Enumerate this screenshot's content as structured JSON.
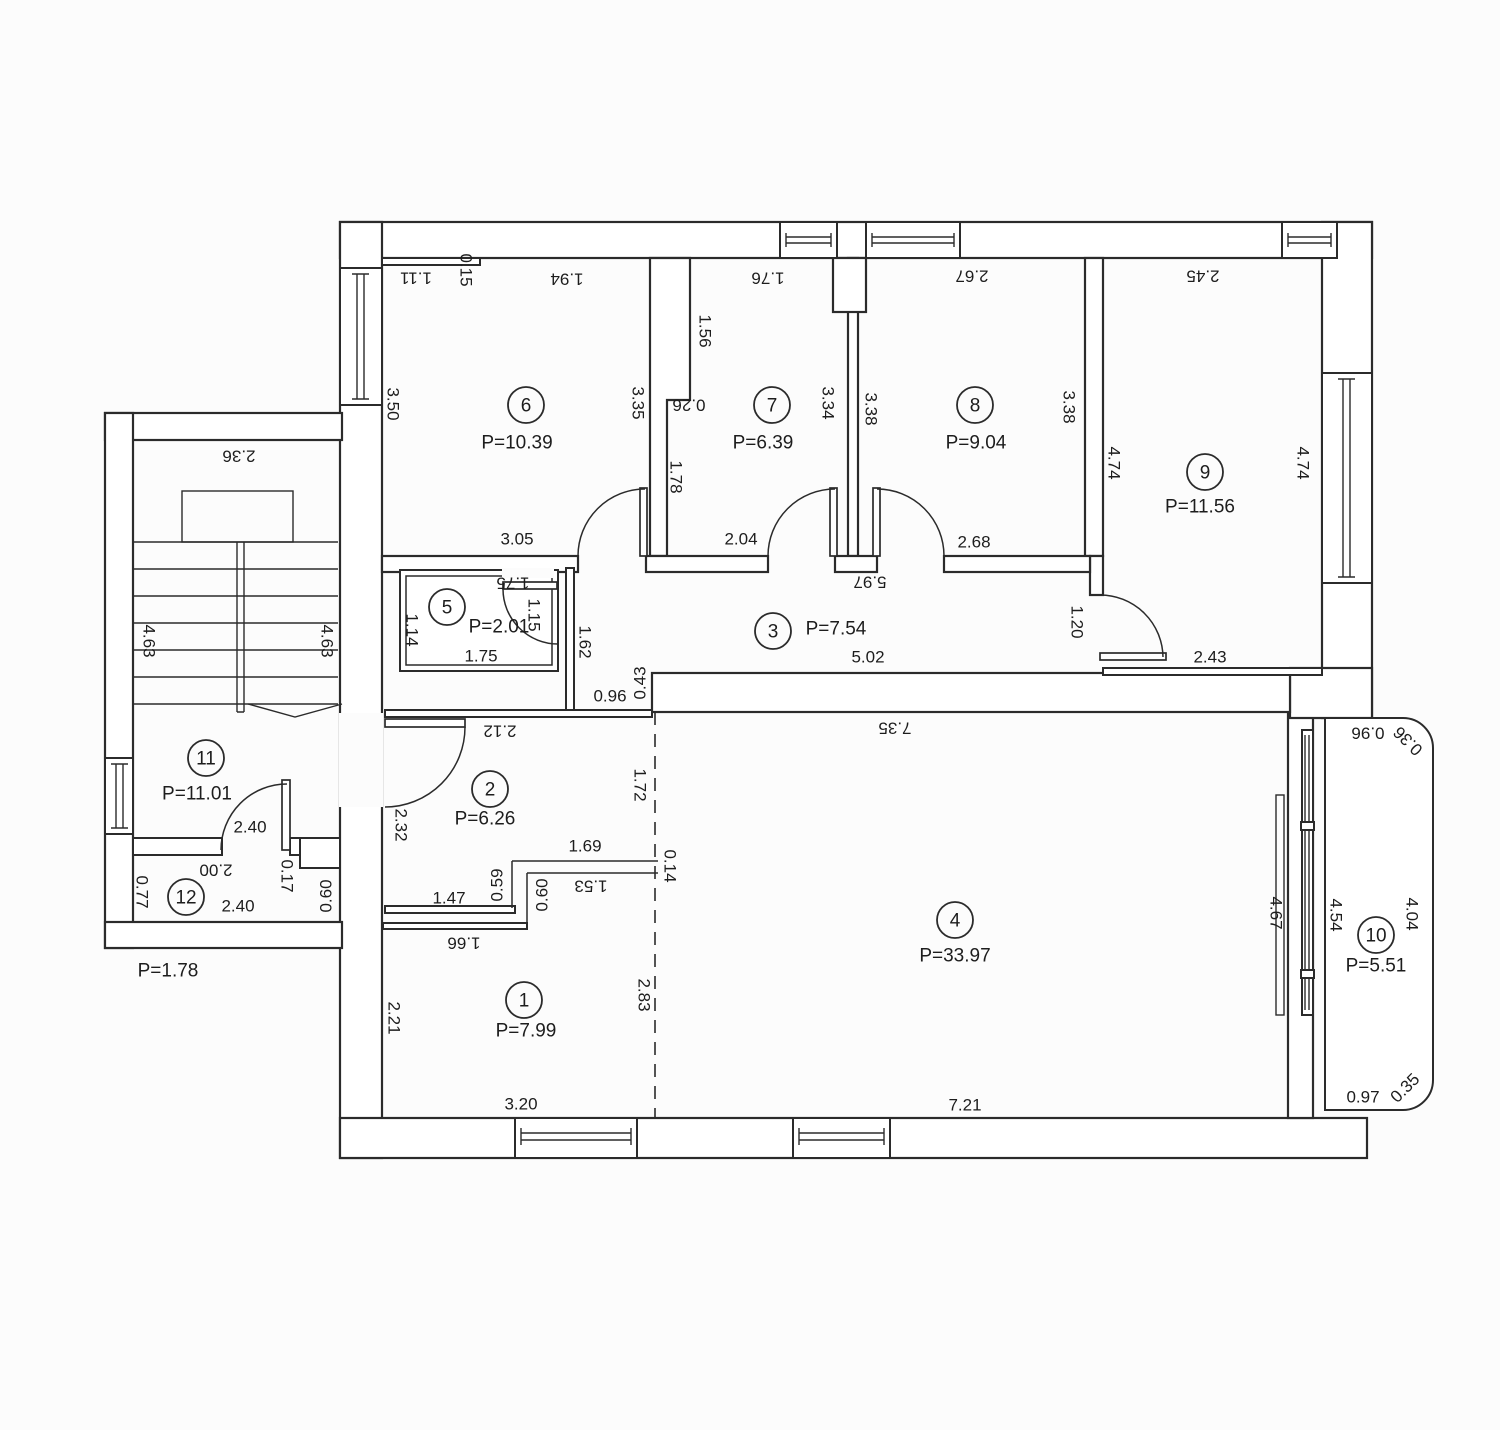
{
  "meta": {
    "drawing_type": "apartment floor plan",
    "area_prefix": "P="
  },
  "colors": {
    "background": "#fcfcfc",
    "line": "#2b2b2b",
    "text": "#1d1d1d"
  },
  "rooms": [
    {
      "number": "1",
      "area_label": "P=7.99",
      "circle": {
        "x": 524,
        "y": 1000
      },
      "label": {
        "x": 526,
        "y": 1031
      }
    },
    {
      "number": "2",
      "area_label": "P=6.26",
      "circle": {
        "x": 490,
        "y": 789
      },
      "label": {
        "x": 485,
        "y": 819
      }
    },
    {
      "number": "3",
      "area_label": "P=7.54",
      "circle": {
        "x": 773,
        "y": 631
      },
      "label": {
        "x": 836,
        "y": 629
      }
    },
    {
      "number": "4",
      "area_label": "P=33.97",
      "circle": {
        "x": 955,
        "y": 920
      },
      "label": {
        "x": 955,
        "y": 956
      }
    },
    {
      "number": "5",
      "area_label": "P=2.01",
      "circle": {
        "x": 447,
        "y": 607
      },
      "label": {
        "x": 499,
        "y": 627
      }
    },
    {
      "number": "6",
      "area_label": "P=10.39",
      "circle": {
        "x": 526,
        "y": 405
      },
      "label": {
        "x": 517,
        "y": 443
      }
    },
    {
      "number": "7",
      "area_label": "P=6.39",
      "circle": {
        "x": 772,
        "y": 405
      },
      "label": {
        "x": 763,
        "y": 443
      }
    },
    {
      "number": "8",
      "area_label": "P=9.04",
      "circle": {
        "x": 975,
        "y": 405
      },
      "label": {
        "x": 976,
        "y": 443
      }
    },
    {
      "number": "9",
      "area_label": "P=11.56",
      "circle": {
        "x": 1205,
        "y": 472
      },
      "label": {
        "x": 1200,
        "y": 507
      }
    },
    {
      "number": "10",
      "area_label": "P=5.51",
      "circle": {
        "x": 1376,
        "y": 935
      },
      "label": {
        "x": 1376,
        "y": 966
      }
    },
    {
      "number": "11",
      "area_label": "P=11.01",
      "circle": {
        "x": 206,
        "y": 758
      },
      "label": {
        "x": 197,
        "y": 794
      }
    },
    {
      "number": "12",
      "area_label": "",
      "circle": {
        "x": 186,
        "y": 897
      },
      "label": {
        "x": 0,
        "y": 0
      }
    }
  ],
  "outside_labels": [
    {
      "text": "P=1.78",
      "x": 168,
      "y": 971,
      "rot": 0
    }
  ],
  "dimensions": [
    {
      "text": "1.11",
      "x": 416,
      "y": 278,
      "rot": 180
    },
    {
      "text": "0.15",
      "x": 466,
      "y": 270,
      "rot": 90
    },
    {
      "text": "1.94",
      "x": 567,
      "y": 279,
      "rot": 180
    },
    {
      "text": "3.50",
      "x": 393,
      "y": 404,
      "rot": 90
    },
    {
      "text": "3.35",
      "x": 638,
      "y": 403,
      "rot": 90
    },
    {
      "text": "3.05",
      "x": 517,
      "y": 539,
      "rot": 0
    },
    {
      "text": "1.76",
      "x": 768,
      "y": 278,
      "rot": 180
    },
    {
      "text": "1.56",
      "x": 705,
      "y": 331,
      "rot": 90
    },
    {
      "text": "0.26",
      "x": 689,
      "y": 405,
      "rot": 180
    },
    {
      "text": "1.78",
      "x": 676,
      "y": 477,
      "rot": 90
    },
    {
      "text": "3.34",
      "x": 828,
      "y": 403,
      "rot": 90
    },
    {
      "text": "2.04",
      "x": 741,
      "y": 539,
      "rot": 0
    },
    {
      "text": "2.67",
      "x": 972,
      "y": 276,
      "rot": 180
    },
    {
      "text": "3.38",
      "x": 871,
      "y": 409,
      "rot": 90
    },
    {
      "text": "3.38",
      "x": 1069,
      "y": 407,
      "rot": 90
    },
    {
      "text": "2.68",
      "x": 974,
      "y": 542,
      "rot": 0
    },
    {
      "text": "2.45",
      "x": 1203,
      "y": 276,
      "rot": 180
    },
    {
      "text": "4.74",
      "x": 1114,
      "y": 463,
      "rot": 90
    },
    {
      "text": "4.74",
      "x": 1303,
      "y": 463,
      "rot": 90
    },
    {
      "text": "1.20",
      "x": 1077,
      "y": 622,
      "rot": 90
    },
    {
      "text": "2.43",
      "x": 1210,
      "y": 657,
      "rot": 0
    },
    {
      "text": "5.97",
      "x": 870,
      "y": 582,
      "rot": 180
    },
    {
      "text": "1.62",
      "x": 585,
      "y": 642,
      "rot": 90
    },
    {
      "text": "5.02",
      "x": 868,
      "y": 657,
      "rot": 0
    },
    {
      "text": "1.75",
      "x": 513,
      "y": 583,
      "rot": 180
    },
    {
      "text": "1.14",
      "x": 412,
      "y": 630,
      "rot": 90
    },
    {
      "text": "1.15",
      "x": 534,
      "y": 615,
      "rot": 90
    },
    {
      "text": "1.75",
      "x": 481,
      "y": 656,
      "rot": 0
    },
    {
      "text": "0.96",
      "x": 610,
      "y": 696,
      "rot": 0
    },
    {
      "text": "0.43",
      "x": 640,
      "y": 683,
      "rot": -90
    },
    {
      "text": "2.12",
      "x": 500,
      "y": 731,
      "rot": 180
    },
    {
      "text": "2.32",
      "x": 401,
      "y": 825,
      "rot": 90
    },
    {
      "text": "1.72",
      "x": 640,
      "y": 785,
      "rot": 90
    },
    {
      "text": "1.69",
      "x": 585,
      "y": 846,
      "rot": 0
    },
    {
      "text": "0.14",
      "x": 670,
      "y": 866,
      "rot": 90
    },
    {
      "text": "0.59",
      "x": 497,
      "y": 885,
      "rot": -90
    },
    {
      "text": "0.60",
      "x": 542,
      "y": 895,
      "rot": -90
    },
    {
      "text": "1.53",
      "x": 591,
      "y": 886,
      "rot": 180
    },
    {
      "text": "1.47",
      "x": 449,
      "y": 898,
      "rot": 0
    },
    {
      "text": "1.66",
      "x": 464,
      "y": 943,
      "rot": 180
    },
    {
      "text": "2.21",
      "x": 394,
      "y": 1018,
      "rot": 90
    },
    {
      "text": "2.83",
      "x": 644,
      "y": 995,
      "rot": 90
    },
    {
      "text": "3.20",
      "x": 521,
      "y": 1104,
      "rot": 0
    },
    {
      "text": "7.35",
      "x": 895,
      "y": 728,
      "rot": 180
    },
    {
      "text": "7.21",
      "x": 965,
      "y": 1105,
      "rot": 0
    },
    {
      "text": "4.67",
      "x": 1276,
      "y": 913,
      "rot": 90
    },
    {
      "text": "0.36",
      "x": 1408,
      "y": 741,
      "rot": 225
    },
    {
      "text": "0.96",
      "x": 1368,
      "y": 733,
      "rot": 180
    },
    {
      "text": "4.54",
      "x": 1336,
      "y": 915,
      "rot": 90
    },
    {
      "text": "4.04",
      "x": 1412,
      "y": 914,
      "rot": 90
    },
    {
      "text": "0.97",
      "x": 1363,
      "y": 1097,
      "rot": 0
    },
    {
      "text": "0.35",
      "x": 1405,
      "y": 1088,
      "rot": -45
    },
    {
      "text": "2.36",
      "x": 239,
      "y": 456,
      "rot": 180
    },
    {
      "text": "4.63",
      "x": 149,
      "y": 641,
      "rot": 90
    },
    {
      "text": "4.63",
      "x": 327,
      "y": 641,
      "rot": 90
    },
    {
      "text": "2.40",
      "x": 250,
      "y": 827,
      "rot": 0
    },
    {
      "text": "2.00",
      "x": 216,
      "y": 870,
      "rot": 180
    },
    {
      "text": "2.40",
      "x": 238,
      "y": 906,
      "rot": 0
    },
    {
      "text": "0.77",
      "x": 142,
      "y": 892,
      "rot": 90
    },
    {
      "text": "0.17",
      "x": 287,
      "y": 876,
      "rot": 90
    },
    {
      "text": "0.60",
      "x": 326,
      "y": 896,
      "rot": -90
    }
  ]
}
